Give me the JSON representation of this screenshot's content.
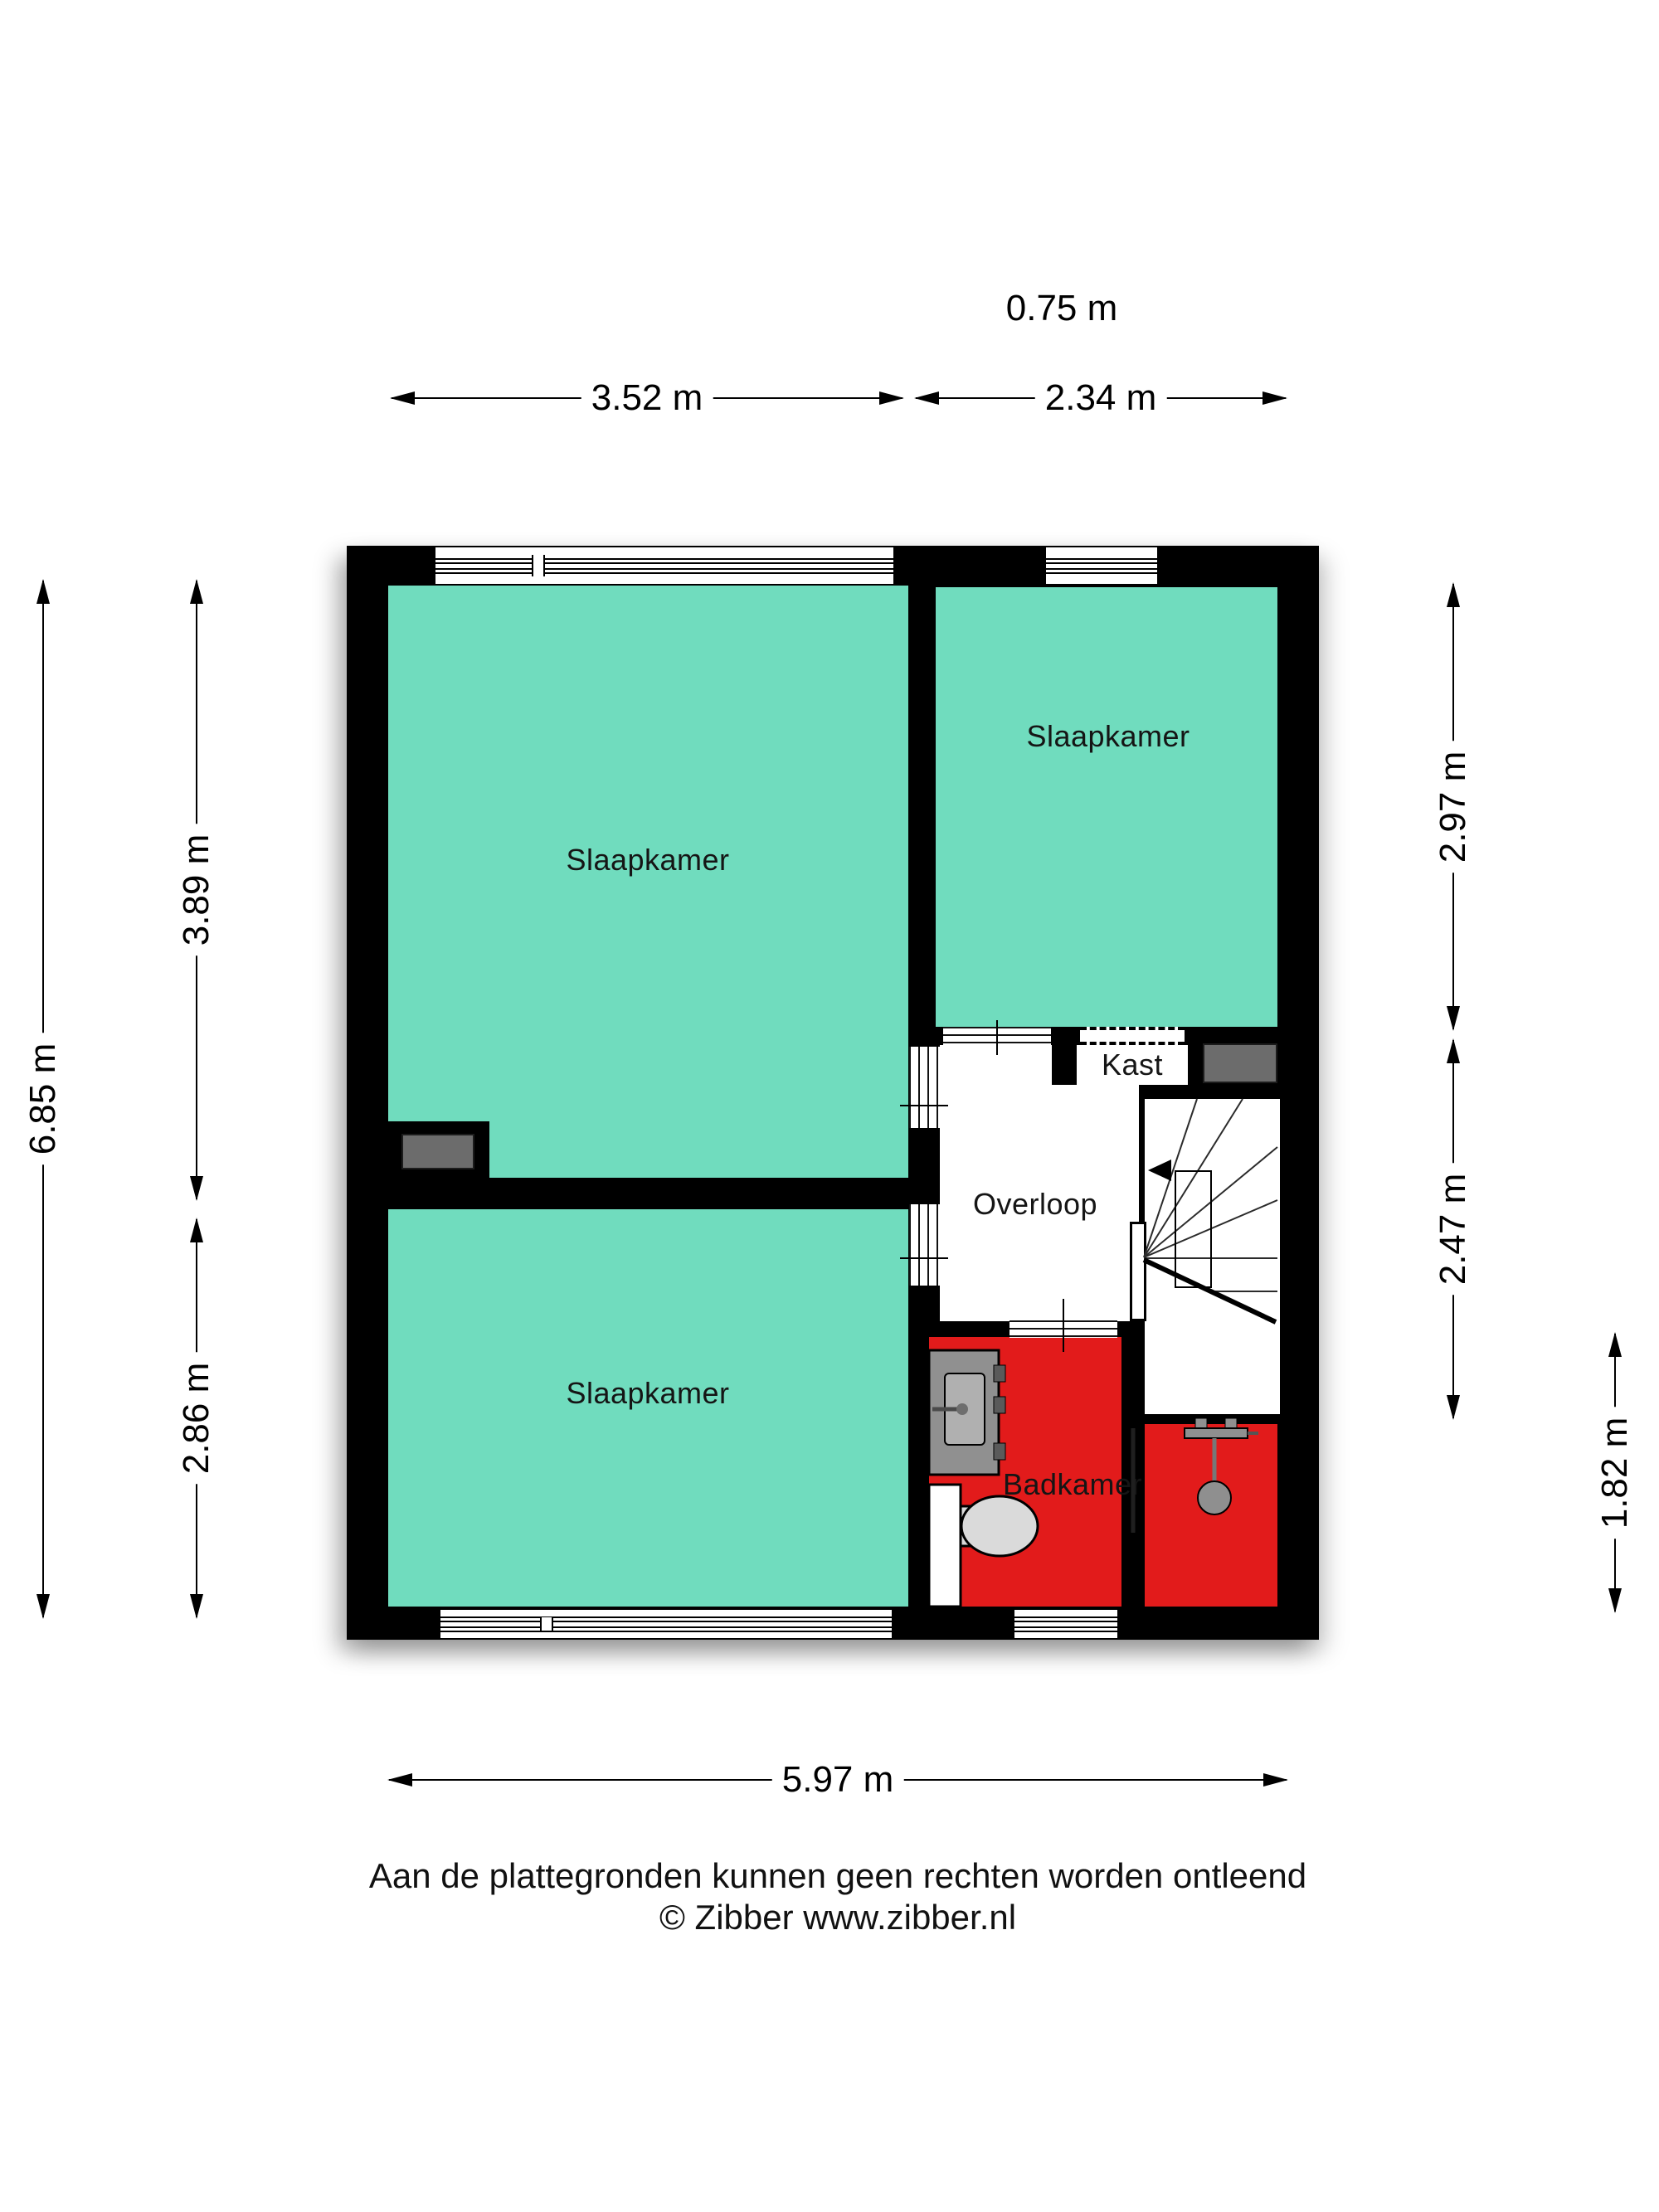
{
  "rooms": {
    "bedroom_top_left": {
      "label": "Slaapkamer"
    },
    "bedroom_top_right": {
      "label": "Slaapkamer"
    },
    "bedroom_bottom_left": {
      "label": "Slaapkamer"
    },
    "landing": {
      "label": "Overloop"
    },
    "closet": {
      "label": "Kast"
    },
    "bathroom": {
      "label": "Badkamer"
    }
  },
  "dimensions": {
    "top_offset": "0.75 m",
    "top_left_width": "3.52 m",
    "top_right_width": "2.34 m",
    "left_total_height": "6.85 m",
    "left_upper_height": "3.89 m",
    "left_lower_height": "2.86 m",
    "right_upper_height": "2.97 m",
    "right_middle_height": "2.47 m",
    "right_lower_height": "1.82 m",
    "bottom_width": "5.97 m"
  },
  "footer": {
    "disclaimer": "Aan de plattegronden kunnen geen rechten worden ontleend",
    "credit": "© Zibber www.zibber.nl"
  },
  "colors": {
    "room_fill": "#70DCBE",
    "bathroom_fill": "#E21B1B",
    "wall": "#000000",
    "duct_gray": "#6C6C6C",
    "background": "#FFFFFF"
  },
  "fixtures": {
    "stairs": "winder-staircase",
    "vanity": "vanity-sink",
    "toilet": "toilet",
    "shower": "shower-head",
    "partition": "glass-partition"
  }
}
